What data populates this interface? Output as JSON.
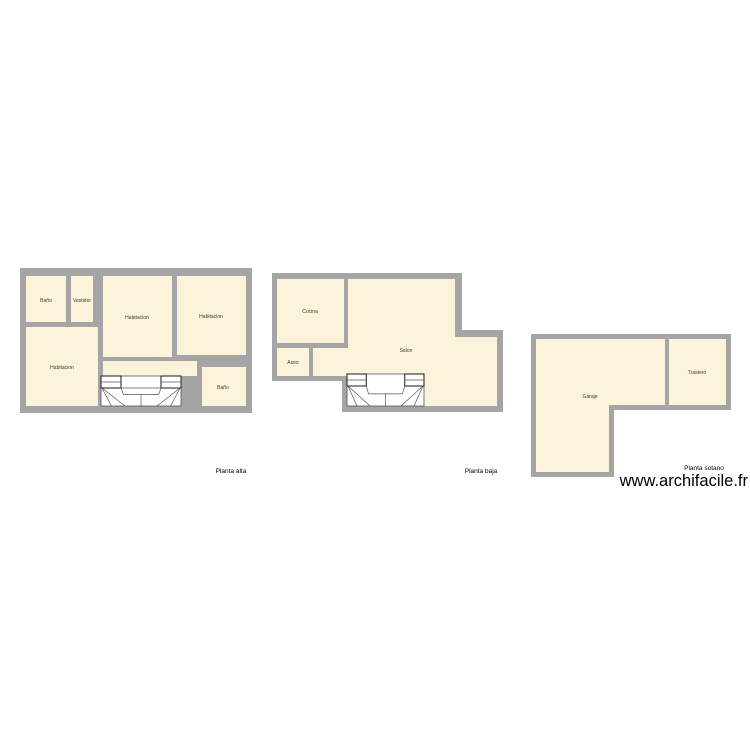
{
  "page": {
    "background": "#ffffff"
  },
  "watermark": {
    "text": "www.archifacile.fr",
    "color": "#000000",
    "pos": [
      748,
      486
    ]
  },
  "colors": {
    "wall": "#a5a5a5",
    "room_fill": "#fbf4da",
    "stair_fill": "#ffffff",
    "stair_line": "#555555",
    "stair_box_line": "#1a1a1a",
    "room_label": "#3d3a35",
    "plan_label": "#000000"
  },
  "plans": [
    {
      "id": "planta-alta",
      "label": "Planta alta",
      "label_pos": [
        231,
        471
      ],
      "outline": [
        [
          20,
          268
        ],
        [
          252,
          268
        ],
        [
          252,
          413
        ],
        [
          20,
          413
        ]
      ],
      "rooms": [
        {
          "id": "bano-1",
          "label": "Baño",
          "label_pos": [
            46,
            300
          ],
          "poly": [
            [
              26,
              276
            ],
            [
              66,
              276
            ],
            [
              66,
              322
            ],
            [
              26,
              322
            ]
          ]
        },
        {
          "id": "vestidor",
          "label": "Vestidor",
          "label_pos": [
            82,
            300
          ],
          "poly": [
            [
              71,
              276
            ],
            [
              93,
              276
            ],
            [
              93,
              322
            ],
            [
              71,
              322
            ]
          ]
        },
        {
          "id": "habitacion-1",
          "label": "Habitacion",
          "label_pos": [
            137,
            317
          ],
          "poly": [
            [
              103,
              276
            ],
            [
              172,
              276
            ],
            [
              172,
              357
            ],
            [
              103,
              357
            ]
          ]
        },
        {
          "id": "habitacion-2",
          "label": "Habitacion",
          "label_pos": [
            211,
            316
          ],
          "poly": [
            [
              177,
              276
            ],
            [
              246,
              276
            ],
            [
              246,
              355
            ],
            [
              177,
              355
            ]
          ]
        },
        {
          "id": "habitacion-3",
          "label": "Habitacion",
          "label_pos": [
            62,
            367
          ],
          "poly": [
            [
              26,
              327
            ],
            [
              98,
              327
            ],
            [
              98,
              406
            ],
            [
              26,
              406
            ]
          ]
        },
        {
          "id": "pasillo",
          "label": "",
          "label_pos": [
            150,
            369
          ],
          "poly": [
            [
              103,
              361
            ],
            [
              197,
              361
            ],
            [
              197,
              376
            ],
            [
              103,
              376
            ]
          ]
        },
        {
          "id": "bano-2",
          "label": "Baño",
          "label_pos": [
            223,
            387
          ],
          "poly": [
            [
              202,
              367
            ],
            [
              246,
              367
            ],
            [
              246,
              406
            ],
            [
              202,
              406
            ]
          ]
        }
      ],
      "stairs": [
        {
          "rect": [
            101,
            376,
            80,
            30
          ],
          "mid_band": true
        }
      ]
    },
    {
      "id": "planta-baja",
      "label": "Planta baja",
      "label_pos": [
        481,
        471
      ],
      "outline": [
        [
          272,
          273
        ],
        [
          462,
          273
        ],
        [
          462,
          330
        ],
        [
          503,
          330
        ],
        [
          503,
          412
        ],
        [
          342,
          412
        ],
        [
          342,
          381
        ],
        [
          272,
          381
        ]
      ],
      "rooms": [
        {
          "id": "cocina",
          "label": "Cocina",
          "label_pos": [
            310,
            311
          ],
          "poly": [
            [
              277,
              279
            ],
            [
              344,
              279
            ],
            [
              344,
              343
            ],
            [
              277,
              343
            ]
          ]
        },
        {
          "id": "aseo",
          "label": "Aseo",
          "label_pos": [
            293,
            362
          ],
          "poly": [
            [
              277,
              348
            ],
            [
              309,
              348
            ],
            [
              309,
              376
            ],
            [
              277,
              376
            ]
          ]
        },
        {
          "id": "salon",
          "label": "Salon",
          "label_pos": [
            406,
            350
          ],
          "poly": [
            [
              348,
              279
            ],
            [
              455,
              279
            ],
            [
              455,
              337
            ],
            [
              497,
              337
            ],
            [
              497,
              406
            ],
            [
              347,
              406
            ],
            [
              347,
              376
            ],
            [
              313,
              376
            ],
            [
              313,
              348
            ],
            [
              348,
              348
            ]
          ]
        }
      ],
      "stairs": [
        {
          "rect": [
            347,
            374,
            77,
            32
          ],
          "mid_band": false
        }
      ]
    },
    {
      "id": "planta-sotano",
      "label": "Planta sotano",
      "label_pos": [
        704,
        468
      ],
      "outline": [
        [
          531,
          334
        ],
        [
          731,
          334
        ],
        [
          731,
          410
        ],
        [
          614,
          410
        ],
        [
          614,
          477
        ],
        [
          531,
          477
        ]
      ],
      "rooms": [
        {
          "id": "garaje",
          "label": "Garaje",
          "label_pos": [
            590,
            396
          ],
          "poly": [
            [
              536,
              339
            ],
            [
              665,
              339
            ],
            [
              665,
              405
            ],
            [
              609,
              405
            ],
            [
              609,
              472
            ],
            [
              536,
              472
            ]
          ]
        },
        {
          "id": "trastero",
          "label": "Trastero",
          "label_pos": [
            697,
            372
          ],
          "poly": [
            [
              669,
              339
            ],
            [
              726,
              339
            ],
            [
              726,
              405
            ],
            [
              669,
              405
            ]
          ]
        }
      ],
      "stairs": []
    }
  ]
}
